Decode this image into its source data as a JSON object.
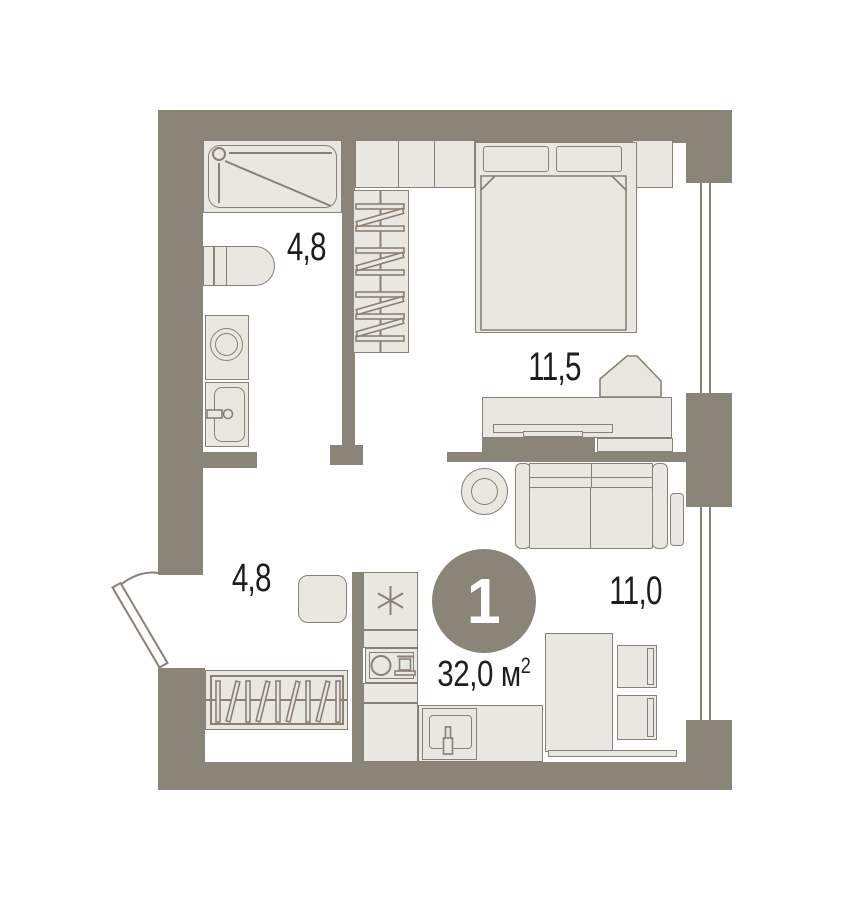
{
  "plan": {
    "badge": "1",
    "total_area": {
      "value": "32,0",
      "unit": "м",
      "sup": "2"
    },
    "rooms": {
      "bathroom": {
        "area": "4,8"
      },
      "bedroom": {
        "area": "11,5"
      },
      "hall": {
        "area": "4,8"
      },
      "living": {
        "area": "11,0"
      }
    },
    "icons": {
      "fridge": "snowflake-icon",
      "stove": "burner-and-pot-icon",
      "entrance": "door-swing-icon"
    },
    "colors": {
      "wall": "#8B8478",
      "fill": "#E9E7E1",
      "line": "#8A8176",
      "text": "#1E1E1C",
      "badge_text": "#FFFFFF",
      "bg": "#FFFFFF"
    }
  }
}
